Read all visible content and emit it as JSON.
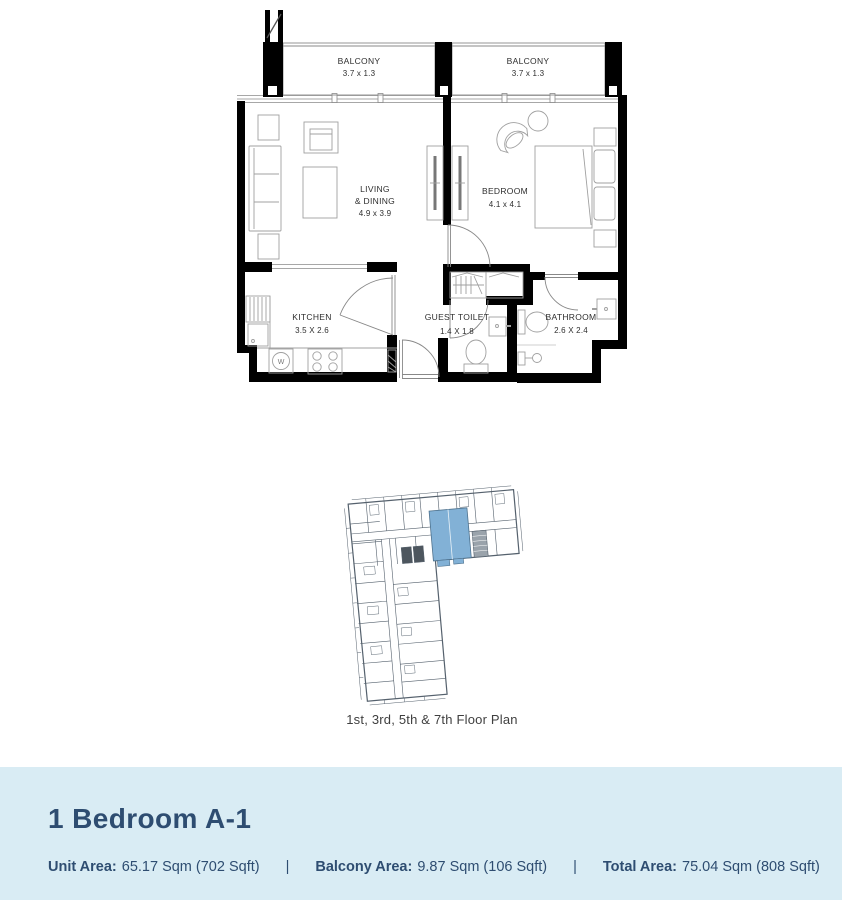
{
  "floor_plan": {
    "balcony_left": {
      "name": "BALCONY",
      "dims": "3.7 x 1.3"
    },
    "balcony_right": {
      "name": "BALCONY",
      "dims": "3.7 x 1.3"
    },
    "living": {
      "line1": "LIVING",
      "line2": "& DINING",
      "dims": "4.9 x 3.9"
    },
    "bedroom": {
      "name": "BEDROOM",
      "dims": "4.1 x 4.1"
    },
    "kitchen": {
      "name": "KITCHEN",
      "dims": "3.5 X 2.6"
    },
    "guest_toilet": {
      "name": "GUEST TOILET",
      "dims": "1.4 X 1.8"
    },
    "bathroom": {
      "name": "BATHROOM",
      "dims": "2.6 X 2.4"
    },
    "washer_label": "W"
  },
  "key_plan": {
    "caption": "1st, 3rd, 5th & 7th Floor Plan",
    "highlight_color": "#82b1d6"
  },
  "unit_info": {
    "title": "1 Bedroom A-1",
    "separator": "|",
    "areas": [
      {
        "label": "Unit Area:",
        "value": "65.17 Sqm (702 Sqft)"
      },
      {
        "label": "Balcony Area:",
        "value": "9.87 Sqm (106 Sqft)"
      },
      {
        "label": "Total Area:",
        "value": "75.04 Sqm (808 Sqft)"
      }
    ]
  },
  "colors": {
    "band_bg": "#d9ecf4",
    "navy_text": "#2e4d71",
    "wall": "#000000",
    "furniture_line": "#9a9a9a",
    "keyplan_line": "#55616d"
  }
}
